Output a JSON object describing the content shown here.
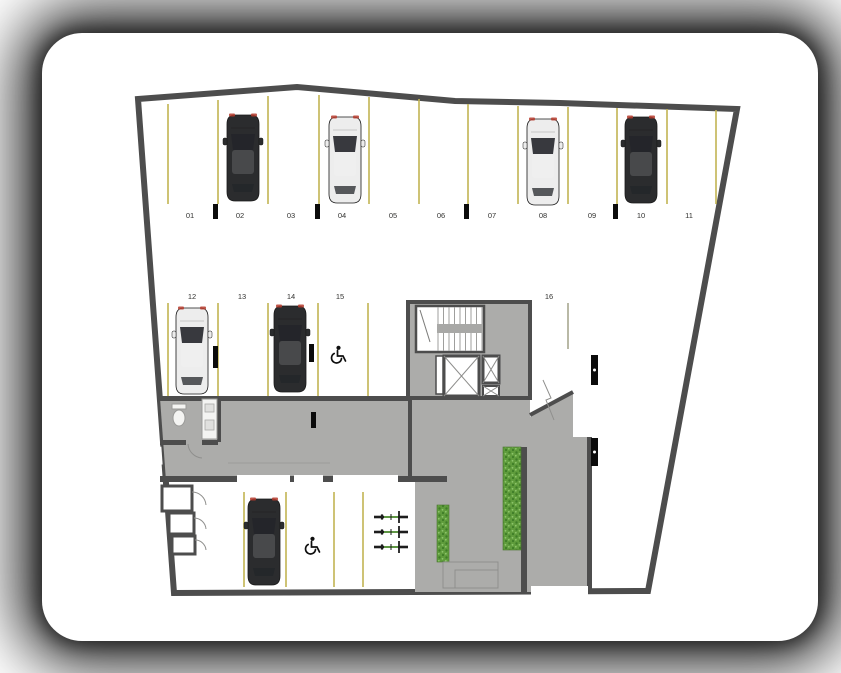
{
  "colors": {
    "card": "#ffffff",
    "floor": "#c9c9c7",
    "floor-speckle": "#b6b6b4",
    "concrete": "#acacaa",
    "wall": "#4d4d4d",
    "parking-line": "#c2b452",
    "room": "#ffffff",
    "planting": "#5f9c3c",
    "planting-dark": "#3f7d28",
    "car-dark": "#2b2c2e",
    "car-silver": "#ededed",
    "marker": "#0b0b0b"
  },
  "plan": {
    "spots": [
      {
        "label": "01",
        "occupied": false
      },
      {
        "label": "02",
        "occupied": true,
        "vehicle": "dark"
      },
      {
        "label": "03",
        "occupied": false
      },
      {
        "label": "04",
        "occupied": true,
        "vehicle": "silver"
      },
      {
        "label": "05",
        "occupied": false
      },
      {
        "label": "06",
        "occupied": false
      },
      {
        "label": "07",
        "occupied": false
      },
      {
        "label": "08",
        "occupied": true,
        "vehicle": "silver"
      },
      {
        "label": "09",
        "occupied": false
      },
      {
        "label": "10",
        "occupied": true,
        "vehicle": "dark"
      },
      {
        "label": "11",
        "occupied": false
      },
      {
        "label": "12",
        "occupied": true,
        "vehicle": "silver"
      },
      {
        "label": "13",
        "occupied": false
      },
      {
        "label": "14",
        "occupied": true,
        "vehicle": "dark"
      },
      {
        "label": "15",
        "occupied": false,
        "accessible": true
      },
      {
        "label": "16",
        "occupied": false
      }
    ],
    "lower_area": {
      "parked_vehicle": "dark",
      "accessible_spot": true,
      "bicycle_count": 3,
      "planting_strips": 2
    },
    "features": [
      "staircase",
      "elevator",
      "restroom",
      "storage-rooms",
      "ramp",
      "driveway"
    ]
  }
}
